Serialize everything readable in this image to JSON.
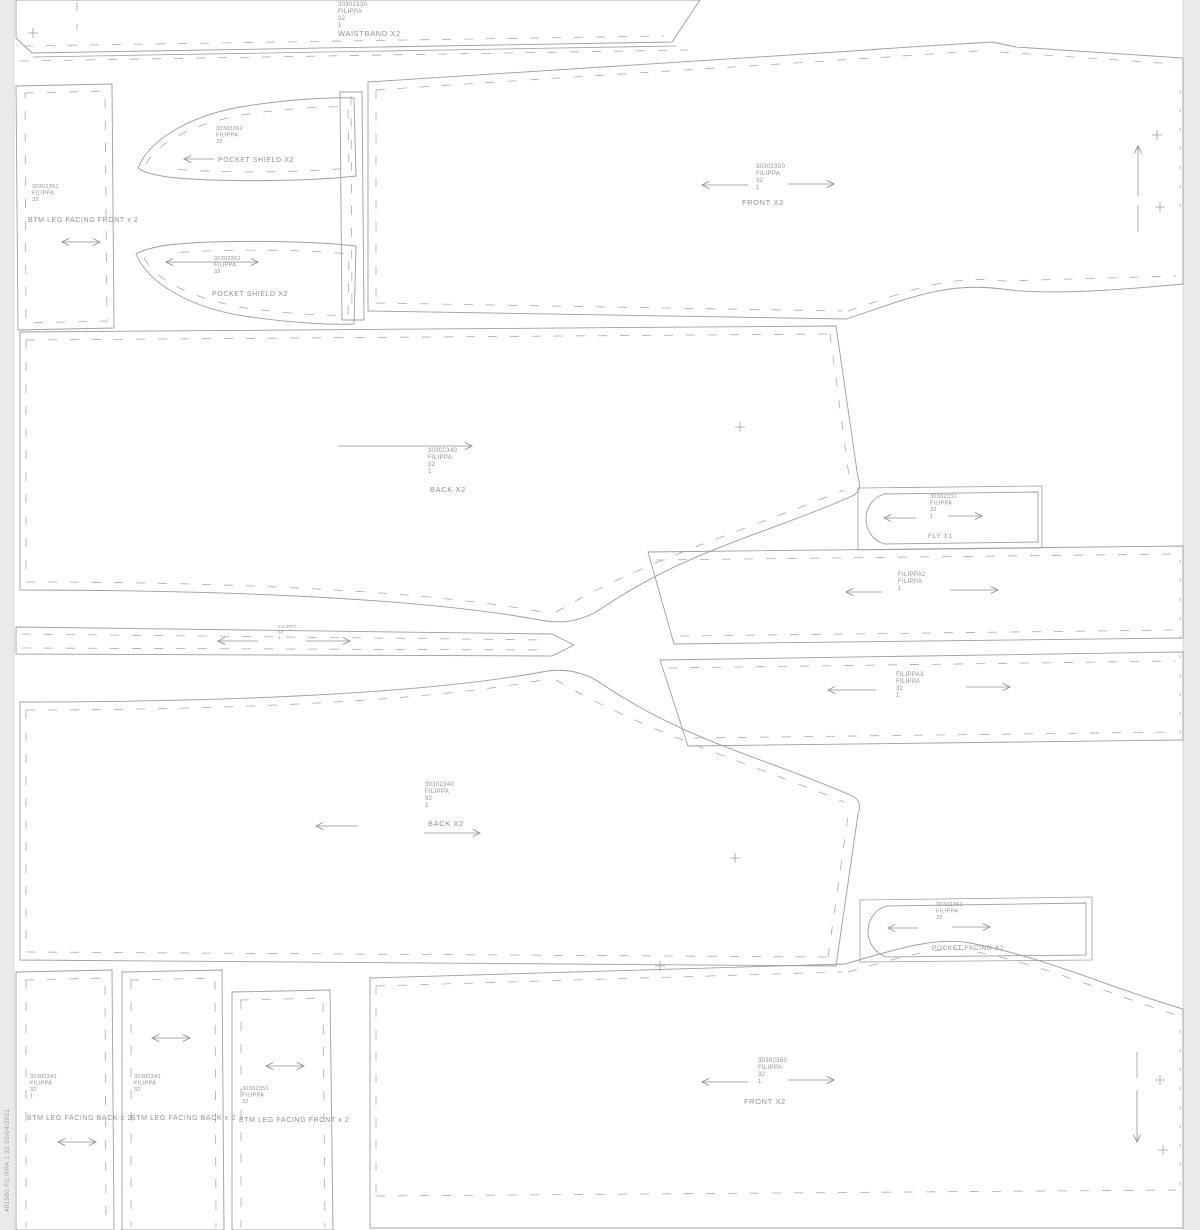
{
  "meta": {
    "style_name": "FILIPPA",
    "size": "32",
    "edge_text": "401580  FILIPPA  1  32  10/04/2021",
    "colors": {
      "sheet": "#ffffff",
      "margin": "#e9eaea",
      "line": "#9aa0a4",
      "text": "#8f9396"
    }
  },
  "sheet": {
    "dashes": [
      "M 1180,90 L 1180,212",
      "M 1180,560 L 1180,735",
      "M 1180,1030 L 1180,1200"
    ]
  },
  "pieces": [
    {
      "name": "front-top",
      "outline": "M 368,82 C 500,73 720,60 852,51 C 922,46 962,44 992,42 L 1016,47 L 1183,58 L 1183,284 C 1108,291 1044,295 1002,289 C 944,281 902,301 846,319 L 368,311 Z",
      "dashed": [
        "M 376,90 C 520,80 820,62 990,50",
        "M 1000,52 L 1176,64",
        "M 376,303 L 842,311",
        "M 848,311 C 905,292 950,274 1004,281 L 1176,276",
        "M 376,90 L 376,303"
      ],
      "solid": [
        "M 1138,206 L 1138,232"
      ],
      "label": {
        "x": 756,
        "y": 168,
        "size": 6,
        "lh": 7,
        "lines": [
          "30302350",
          "FILIPPA",
          "32",
          "1"
        ]
      },
      "piece_name": {
        "text": "FRONT X2",
        "x": 742,
        "y": 205,
        "size": 7.5
      },
      "arrows": [
        {
          "x1": 748,
          "y1": 185,
          "x2": 702,
          "y2": 185
        },
        {
          "x1": 788,
          "y1": 184,
          "x2": 834,
          "y2": 184
        },
        {
          "x1": 1138,
          "y1": 196,
          "x2": 1138,
          "y2": 146
        }
      ],
      "plus": [
        {
          "x": 1157,
          "y": 135
        },
        {
          "x": 1160,
          "y": 207
        }
      ]
    },
    {
      "name": "waistband",
      "outline": "M 16,0 L 16,38 L 32,53 L 672,42 L 700,0 Z",
      "solid": [
        "M 33,57 L 676,46"
      ],
      "dashed": [
        "M 24,46 L 664,36",
        "M 77,2 L 77,30",
        "M 20,61 L 688,50"
      ],
      "label": {
        "x": 338,
        "y": 6,
        "size": 6,
        "lh": 7,
        "lines": [
          "30302330",
          "FILIPPA",
          "32",
          "1"
        ]
      },
      "piece_name": {
        "text": "WAISTBAND X2",
        "x": 338,
        "y": 36,
        "size": 7.5
      },
      "plus": [
        {
          "x": 33,
          "y": 33
        }
      ]
    },
    {
      "name": "back-upper",
      "outline": "M 20,332 L 836,326 L 858,478 C 862,488 858,494 850,497 C 766,534 688,550 602,608 C 576,626 550,622 540,620 C 414,597 208,590 20,590 Z",
      "dashed": [
        "M 26,340 L 830,334",
        "M 830,334 L 849,476",
        "M 26,340 L 26,582",
        "M 26,582 C 220,582 424,590 542,612",
        "M 556,612 C 640,562 746,530 844,490"
      ],
      "label": {
        "x": 428,
        "y": 452,
        "size": 6,
        "lh": 7,
        "lines": [
          "30302340",
          "FILIPPA",
          "32",
          "1"
        ]
      },
      "piece_name": {
        "text": "BACK X2",
        "x": 430,
        "y": 492,
        "size": 7.5
      },
      "arrows": [
        {
          "x1": 338,
          "y1": 446,
          "x2": 472,
          "y2": 446
        }
      ],
      "plus": [
        {
          "x": 740,
          "y": 427
        }
      ]
    },
    {
      "name": "back-lower",
      "outline": "M 20,702 C 208,702 416,695 542,672 C 552,670 576,666 602,684 C 688,742 766,758 850,795 C 858,798 862,804 858,814 L 836,966 L 20,960 Z",
      "dashed": [
        "M 26,710 L 26,952",
        "M 26,952 L 828,957",
        "M 828,957 L 848,816",
        "M 26,710 C 220,710 424,702 542,680",
        "M 556,680 C 640,730 746,762 844,802"
      ],
      "label": {
        "x": 425,
        "y": 786,
        "size": 6,
        "lh": 7,
        "lines": [
          "30302340",
          "FILIPPA",
          "32",
          "1"
        ]
      },
      "piece_name": {
        "text": "BACK X2",
        "x": 428,
        "y": 826,
        "size": 7.5
      },
      "arrows": [
        {
          "x1": 358,
          "y1": 826,
          "x2": 316,
          "y2": 826
        },
        {
          "x1": 424,
          "y1": 833,
          "x2": 480,
          "y2": 833
        }
      ],
      "plus": [
        {
          "x": 735,
          "y": 858
        }
      ]
    },
    {
      "name": "front-bottom",
      "outline": "M 370,978 L 845,964 C 902,947 938,937 970,943 C 1044,957 1108,987 1183,1009 L 1183,1228 L 370,1228 Z",
      "dashed": [
        "M 376,986 L 842,972",
        "M 848,972 C 908,955 942,945 972,951 C 1046,965 1112,995 1176,1015",
        "M 376,986 L 376,1196",
        "M 376,1196 L 1176,1190"
      ],
      "solid": [
        "M 1137,1052 L 1137,1078"
      ],
      "label": {
        "x": 758,
        "y": 1062,
        "size": 6,
        "lh": 7,
        "lines": [
          "30302350",
          "FILIPPA",
          "32",
          "1"
        ]
      },
      "piece_name": {
        "text": "FRONT X2",
        "x": 744,
        "y": 1104,
        "size": 7.5
      },
      "arrows": [
        {
          "x1": 748,
          "y1": 1082,
          "x2": 702,
          "y2": 1082
        },
        {
          "x1": 788,
          "y1": 1080,
          "x2": 834,
          "y2": 1080
        },
        {
          "x1": 1137,
          "y1": 1090,
          "x2": 1137,
          "y2": 1142
        }
      ],
      "plus": [
        {
          "x": 1160,
          "y": 1080
        },
        {
          "x": 1163,
          "y": 1150
        },
        {
          "x": 660,
          "y": 966
        }
      ]
    },
    {
      "name": "filippa2-strip",
      "outline": "M 648,552 L 1183,546 L 1183,638 L 674,644 Z",
      "dashed": [
        "M 656,560 L 1176,554",
        "M 680,636 L 1176,630"
      ],
      "label": {
        "x": 898,
        "y": 576,
        "size": 6,
        "lh": 7,
        "lines": [
          "FILIPPA2",
          "FILIPPA",
          "1"
        ]
      },
      "arrows": [
        {
          "x1": 882,
          "y1": 592,
          "x2": 846,
          "y2": 592
        },
        {
          "x1": 950,
          "y1": 590,
          "x2": 998,
          "y2": 590
        }
      ]
    },
    {
      "name": "filippa3-strip",
      "outline": "M 660,660 L 1183,652 L 1183,740 L 688,746 Z",
      "dashed": [
        "M 668,668 L 1176,661",
        "M 694,738 L 1176,732"
      ],
      "label": {
        "x": 896,
        "y": 676,
        "size": 6,
        "lh": 7,
        "lines": [
          "FILIPPA3",
          "FILIPPA",
          "32",
          "1"
        ]
      },
      "arrows": [
        {
          "x1": 876,
          "y1": 690,
          "x2": 828,
          "y2": 690
        },
        {
          "x1": 966,
          "y1": 687,
          "x2": 1010,
          "y2": 687
        }
      ]
    },
    {
      "name": "thin-strip",
      "outline": "M 16,627 L 552,634 L 574,645 L 552,656 L 16,654 Z",
      "dashed": [
        "M 22,634 L 548,640",
        "M 22,648 L 545,650"
      ],
      "label": {
        "x": 278,
        "y": 628,
        "size": 4.5,
        "lh": 5.5,
        "lines": [
          "FILIPPA",
          "32",
          "1"
        ]
      },
      "arrows": [
        {
          "x1": 258,
          "y1": 641,
          "x2": 218,
          "y2": 641
        },
        {
          "x1": 306,
          "y1": 641,
          "x2": 350,
          "y2": 641
        }
      ]
    },
    {
      "name": "fly",
      "outline": "M 884,494 L 1038,492 L 1038,542 L 884,544 C 860,536 860,502 884,494 Z",
      "solid": [
        "M 858,488 L 1042,486 L 1042,548 L 858,550 Z"
      ],
      "label": {
        "x": 930,
        "y": 498,
        "size": 5.5,
        "lh": 6.5,
        "lines": [
          "30302331",
          "FILIPPA",
          "32",
          "1"
        ]
      },
      "piece_name": {
        "text": "FLY X1",
        "x": 928,
        "y": 538,
        "size": 6.5
      },
      "arrows": [
        {
          "x1": 916,
          "y1": 518,
          "x2": 884,
          "y2": 518
        },
        {
          "x1": 948,
          "y1": 516,
          "x2": 982,
          "y2": 516
        }
      ]
    },
    {
      "name": "pocket-facing",
      "outline": "M 886,906 L 1086,903 L 1086,955 L 886,957 C 862,948 862,914 886,906 Z",
      "solid": [
        "M 860,900 L 1092,897 L 1092,960 L 860,962 Z"
      ],
      "label": {
        "x": 936,
        "y": 906,
        "size": 5.5,
        "lh": 6.5,
        "lines": [
          "30302361",
          "FILIPPA",
          "32"
        ]
      },
      "piece_name": {
        "text": "POCKET FACING X2",
        "x": 932,
        "y": 950,
        "size": 6.5
      },
      "arrows": [
        {
          "x1": 918,
          "y1": 928,
          "x2": 888,
          "y2": 928
        },
        {
          "x1": 952,
          "y1": 927,
          "x2": 990,
          "y2": 927
        }
      ]
    },
    {
      "name": "btm-leg-facing-front-top",
      "outline": "M 16,86 L 112,84 L 114,328 L 18,330 Z",
      "dashed": [
        "M 25,93 L 105,91 L 107,321 L 26,323 Z"
      ],
      "label": {
        "x": 32,
        "y": 188,
        "size": 5.5,
        "lh": 6.5,
        "lines": [
          "30302351",
          "FILIPPA",
          "32"
        ]
      },
      "piece_name": {
        "text": "BTM LEG FACING FRONT x 2",
        "x": 28,
        "y": 222,
        "size": 7
      },
      "arrows": [
        {
          "x1": 62,
          "y1": 242,
          "x2": 100,
          "y2": 242,
          "heads": "both"
        }
      ]
    },
    {
      "name": "pocket-shield-upper",
      "outline": "M 138,168 C 150,138 194,114 246,106 C 292,99 332,97 354,98 L 356,176 C 302,182 212,182 168,177 C 154,175 143,172 138,168 Z",
      "dashed": [
        "M 146,164 C 158,141 198,122 248,114 C 290,108 330,106 348,107 L 349,168 C 300,173 216,173 172,169"
      ],
      "label": {
        "x": 216,
        "y": 130,
        "size": 5.5,
        "lh": 6.5,
        "lines": [
          "30302362",
          "FILIPPA",
          "32"
        ]
      },
      "piece_name": {
        "text": "POCKET SHIELD X2",
        "x": 218,
        "y": 162,
        "size": 7
      },
      "arrows": [
        {
          "x1": 214,
          "y1": 159,
          "x2": 184,
          "y2": 159
        }
      ]
    },
    {
      "name": "pocket-shield-lower",
      "outline": "M 136,254 C 148,284 192,308 244,316 C 290,323 332,325 354,324 L 356,246 C 302,240 212,240 168,245 C 154,247 143,250 136,254 Z",
      "dashed": [
        "M 144,258 C 156,281 196,300 246,308 C 288,314 328,316 348,315 L 349,254 C 300,249 216,249 172,253"
      ],
      "label": {
        "x": 214,
        "y": 260,
        "size": 5.5,
        "lh": 6.5,
        "lines": [
          "30302362",
          "FILIPPA",
          "32"
        ]
      },
      "piece_name": {
        "text": "POCKET SHIELD X2",
        "x": 212,
        "y": 296,
        "size": 7
      },
      "arrows": [
        {
          "x1": 166,
          "y1": 262,
          "x2": 258,
          "y2": 262,
          "heads": "both"
        }
      ]
    },
    {
      "name": "vertical-strip",
      "outline": "M 340,92 L 362,92 L 364,320 L 342,320 Z",
      "dashed": [
        "M 351,96 L 352,316"
      ]
    },
    {
      "name": "btm-leg-facing-back-1",
      "outline": "M 16,972 L 112,970 L 114,1230 L 16,1230 Z",
      "dashed": [
        "M 25,980 L 105,978 L 106,1228",
        "M 26,980 L 26,1228"
      ],
      "label": {
        "x": 30,
        "y": 1078,
        "size": 5.5,
        "lh": 6.5,
        "lines": [
          "30302341",
          "FILIPPA",
          "32",
          "1"
        ]
      },
      "piece_name": {
        "text": "BTM LEG FACING BACK x 2",
        "x": 27,
        "y": 1120,
        "size": 7
      },
      "arrows": [
        {
          "x1": 58,
          "y1": 1142,
          "x2": 96,
          "y2": 1142,
          "heads": "both"
        }
      ]
    },
    {
      "name": "btm-leg-facing-back-2",
      "outline": "M 122,972 L 222,970 L 224,1230 L 122,1230 Z",
      "dashed": [
        "M 130,980 L 215,978 L 216,1228",
        "M 131,980 L 131,1228"
      ],
      "label": {
        "x": 134,
        "y": 1078,
        "size": 5.5,
        "lh": 6.5,
        "lines": [
          "30302341",
          "FILIPPA",
          "32"
        ]
      },
      "piece_name": {
        "text": "BTM LEG FACING BACK x 2",
        "x": 131,
        "y": 1120,
        "size": 7
      },
      "arrows": [
        {
          "x1": 152,
          "y1": 1038,
          "x2": 190,
          "y2": 1038,
          "heads": "both"
        }
      ]
    },
    {
      "name": "btm-leg-facing-front-bottom",
      "outline": "M 232,992 L 330,990 L 333,1230 L 232,1230 Z",
      "dashed": [
        "M 240,1000 L 323,998 L 325,1228",
        "M 241,1000 L 241,1228"
      ],
      "label": {
        "x": 242,
        "y": 1090,
        "size": 5.5,
        "lh": 6.5,
        "lines": [
          "30302351",
          "FILIPPA",
          "32"
        ]
      },
      "piece_name": {
        "text": "BTM LEG FACING FRONT x 2",
        "x": 239,
        "y": 1122,
        "size": 7
      },
      "arrows": [
        {
          "x1": 266,
          "y1": 1066,
          "x2": 304,
          "y2": 1066,
          "heads": "both"
        }
      ]
    }
  ]
}
